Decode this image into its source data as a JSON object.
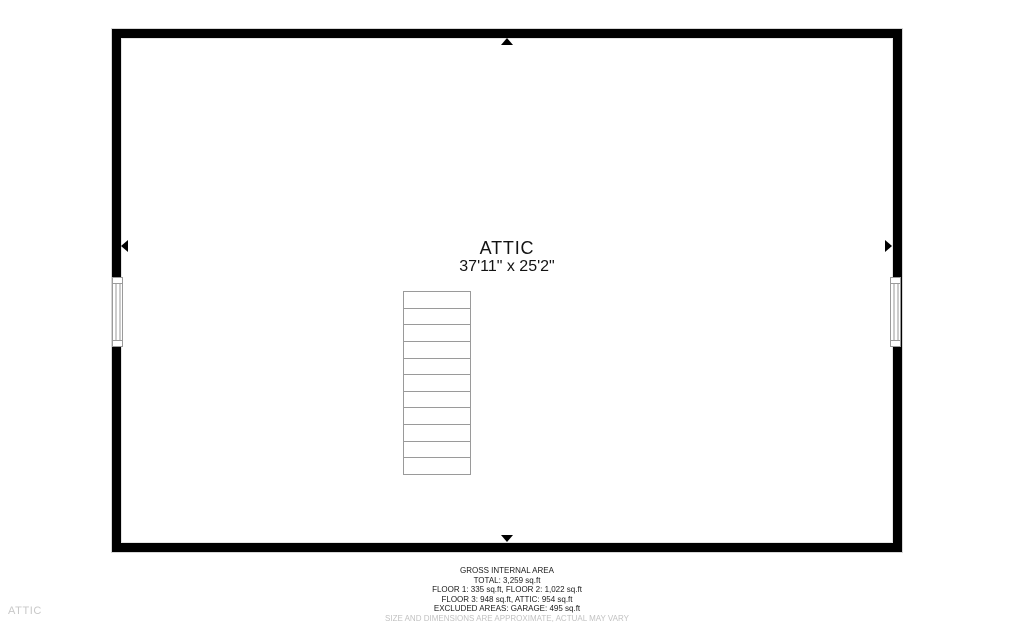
{
  "plan": {
    "room_name": "ATTIC",
    "room_dimensions": "37'11\" x 25'2\"",
    "stairs_steps": 11
  },
  "footer": {
    "lines": [
      "GROSS INTERNAL AREA",
      "TOTAL: 3,259 sq.ft",
      "FLOOR 1: 335 sq.ft, FLOOR 2: 1,022 sq.ft",
      "FLOOR 3: 948 sq.ft, ATTIC: 954 sq.ft",
      "EXCLUDED AREAS: GARAGE: 495 sq.ft"
    ],
    "disclaimer": "SIZE AND DIMENSIONS ARE APPROXIMATE, ACTUAL MAY VARY"
  },
  "corner_label": "ATTIC",
  "colors": {
    "wall": "#000000",
    "stair_line": "#9a9a9a",
    "text": "#1c1c1c",
    "muted_text": "#c8c8c8"
  }
}
